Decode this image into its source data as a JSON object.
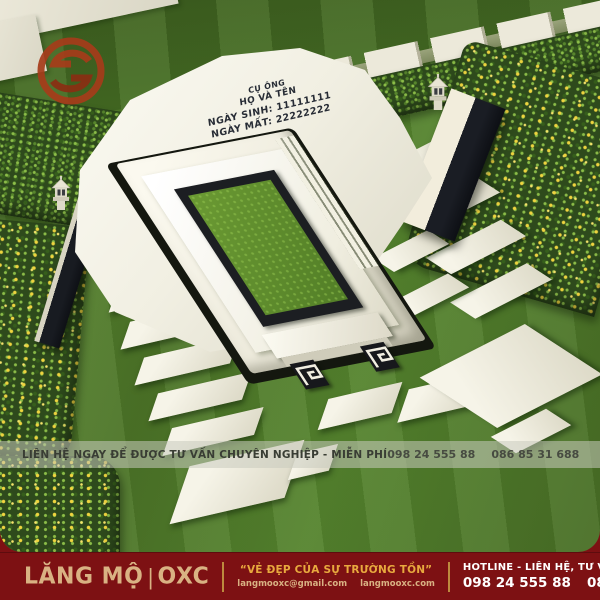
{
  "poster": {
    "watermark": {
      "icon": "oxc-logo-icon",
      "color": "#a63c1a"
    },
    "tomb": {
      "engraving": {
        "line1": "CỤ ÔNG",
        "line2": "HỌ VÀ TÊN",
        "line3": "NGÀY SINH: 11111111",
        "line4": "NGÀY MẤT: 22222222"
      }
    },
    "contact_banner": {
      "message": "LIÊN HỆ NGAY ĐỂ ĐƯỢC TƯ VẤN CHUYÊN NGHIỆP - MIỄN PHÍ",
      "phone1": "098 24 555 88",
      "phone2": "086 85 31 688"
    },
    "footer": {
      "brand_name": "LĂNG MỘ",
      "brand_separator": "|",
      "brand_suffix": "OXC",
      "tagline": "“VẺ ĐẸP CỦA SỰ TRƯỜNG TỒN”",
      "email": "langmooxc@gmail.com",
      "website": "langmooxc.com",
      "hotline_label": "HOTLINE - LIÊN HỆ, TƯ VẤN MIỄN PHÍ",
      "phone1": "098 24 555 88",
      "phone2": "086 85 31 688",
      "colors": {
        "background": "#7d1113",
        "gold": "#e8a93e",
        "tan": "#d9b283",
        "white": "#ffffff"
      }
    }
  }
}
